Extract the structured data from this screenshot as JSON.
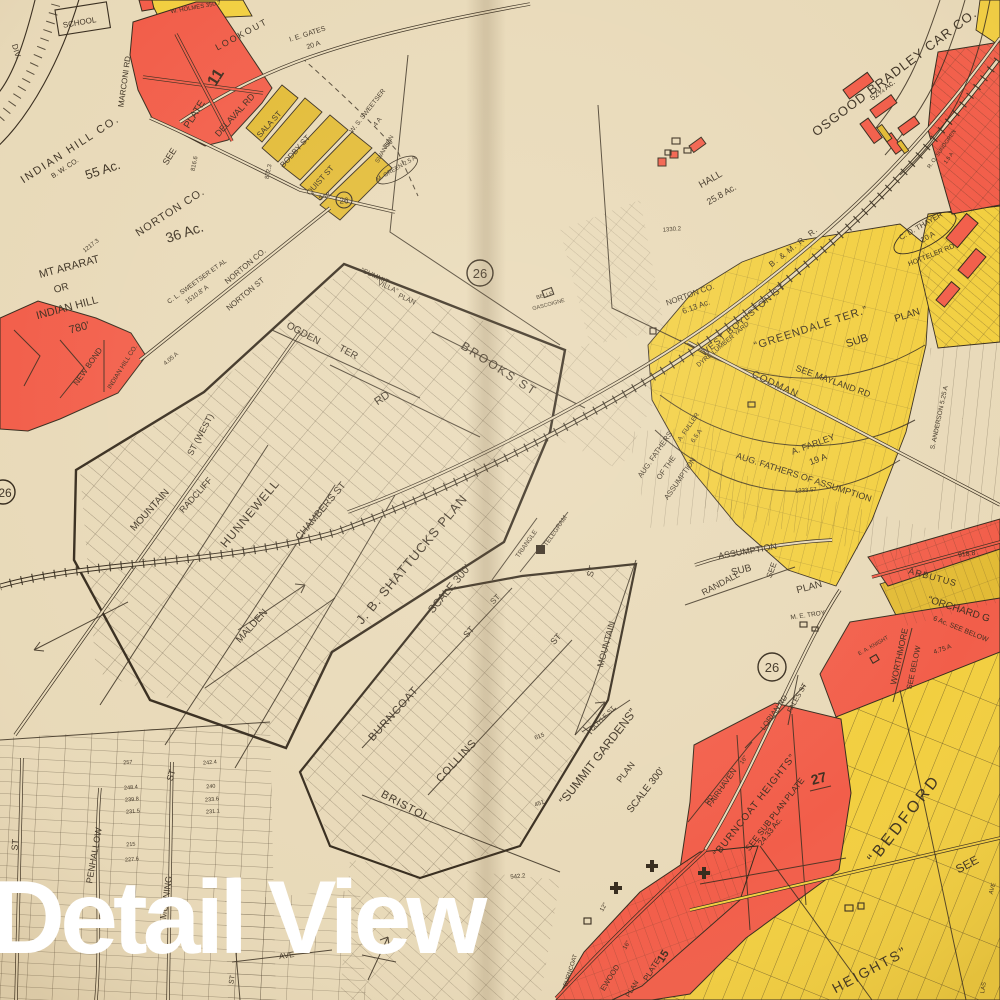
{
  "overlay": {
    "title": "Detail View"
  },
  "palette": {
    "paper": "#e8d9b8",
    "ink": "#33281a",
    "red": "#f25b47",
    "yellow": "#f2ce3d",
    "yellow_deep": "#e2ba32",
    "white": "#ffffff"
  },
  "plate": {
    "number": "26"
  },
  "map_labels": [
    {
      "n": "div",
      "t": "DIV.",
      "x": 14,
      "y": 52,
      "r": 73,
      "s": 8
    },
    {
      "n": "school",
      "t": "SCHOOL",
      "x": 80,
      "y": 25,
      "r": -10,
      "s": 8
    },
    {
      "n": "holmes",
      "t": "W. HOLMES 350.7",
      "x": 196,
      "y": 9,
      "r": -10,
      "s": 6
    },
    {
      "n": "lookout",
      "t": "LOOKOUT",
      "x": 243,
      "y": 37,
      "r": -28,
      "s": 9,
      "ls": 2
    },
    {
      "n": "gates-1",
      "t": "I. E. GATES",
      "x": 308,
      "y": 36,
      "r": -18,
      "s": 7
    },
    {
      "n": "gates-2",
      "t": "20 A",
      "x": 314,
      "y": 47,
      "r": -18,
      "s": 7
    },
    {
      "n": "see-plate-see",
      "t": "SEE",
      "x": 172,
      "y": 158,
      "r": -58,
      "s": 9
    },
    {
      "n": "see-plate-plate",
      "t": "PLATE",
      "x": 197,
      "y": 116,
      "r": -58,
      "s": 10
    },
    {
      "n": "see-plate-11",
      "t": "11",
      "x": 220,
      "y": 80,
      "r": -58,
      "s": 16,
      "b": 1
    },
    {
      "n": "marconi-rd",
      "t": "MARCONI RD",
      "x": 127,
      "y": 82,
      "r": -82,
      "s": 8
    },
    {
      "n": "delaval-rd",
      "t": "DELAVAL RD",
      "x": 237,
      "y": 117,
      "r": -48,
      "s": 9
    },
    {
      "n": "sala-st",
      "t": "SALA ST",
      "x": 271,
      "y": 126,
      "r": -48,
      "s": 8
    },
    {
      "n": "bodby-st",
      "t": "BODBY ST",
      "x": 297,
      "y": 153,
      "r": -48,
      "s": 8
    },
    {
      "n": "quist-st",
      "t": "QUIST ST",
      "x": 322,
      "y": 182,
      "r": -48,
      "s": 8
    },
    {
      "n": "ws-sweetser-1",
      "t": "W. S. SWEETSER",
      "x": 369,
      "y": 112,
      "r": -52,
      "s": 6.5
    },
    {
      "n": "ws-sweetser-2",
      "t": "4 A",
      "x": 379,
      "y": 123,
      "r": -52,
      "s": 6.5
    },
    {
      "n": "swanson",
      "t": "SWANSON",
      "x": 386,
      "y": 150,
      "r": -60,
      "s": 6
    },
    {
      "n": "m-green",
      "t": "M. GREEN 2.5 A",
      "x": 397,
      "y": 170,
      "r": -30,
      "s": 6
    },
    {
      "n": "n548",
      "t": "548.",
      "x": 326,
      "y": 198,
      "r": -20,
      "s": 7
    },
    {
      "n": "n350",
      "t": "350",
      "x": 389,
      "y": 146,
      "r": -40,
      "s": 6.5
    },
    {
      "n": "indian-hill-co",
      "t": "INDIAN HILL CO.",
      "x": 72,
      "y": 152,
      "r": -33,
      "s": 11,
      "ls": 2
    },
    {
      "n": "bw-co",
      "t": "B. W. CO.",
      "x": 66,
      "y": 170,
      "r": -33,
      "s": 7
    },
    {
      "n": "ac-55",
      "t": "55 Ac.",
      "x": 104,
      "y": 174,
      "r": -18,
      "s": 13
    },
    {
      "n": "n816",
      "t": "816.6",
      "x": 196,
      "y": 164,
      "r": -78,
      "s": 6
    },
    {
      "n": "n872",
      "t": "872.3",
      "x": 270,
      "y": 172,
      "r": -78,
      "s": 6
    },
    {
      "n": "norton-co-1",
      "t": "NORTON CO.",
      "x": 172,
      "y": 215,
      "r": -33,
      "s": 11,
      "ls": 1
    },
    {
      "n": "ac-36",
      "t": "36 Ac.",
      "x": 186,
      "y": 237,
      "r": -18,
      "s": 14
    },
    {
      "n": "n1217",
      "t": "1217.3",
      "x": 92,
      "y": 247,
      "r": -38,
      "s": 6
    },
    {
      "n": "mt-ararat-1",
      "t": "MT ARARAT",
      "x": 70,
      "y": 270,
      "r": -15,
      "s": 11
    },
    {
      "n": "mt-ararat-2",
      "t": "OR",
      "x": 62,
      "y": 291,
      "r": -15,
      "s": 10
    },
    {
      "n": "mt-ararat-3",
      "t": "INDIAN HILL",
      "x": 68,
      "y": 311,
      "r": -15,
      "s": 11
    },
    {
      "n": "mt-ararat-4",
      "t": "780'",
      "x": 80,
      "y": 331,
      "r": -15,
      "s": 11
    },
    {
      "n": "cl-sweetser-1",
      "t": "C. L. SWEETSER ET AL",
      "x": 198,
      "y": 283,
      "r": -36,
      "s": 6.5
    },
    {
      "n": "cl-sweetser-2",
      "t": "1510.8' A",
      "x": 198,
      "y": 296,
      "r": -36,
      "s": 6.5
    },
    {
      "n": "norton-co-2",
      "t": "NORTON CO.",
      "x": 247,
      "y": 268,
      "r": -40,
      "s": 8
    },
    {
      "n": "norton-st",
      "t": "NORTON ST",
      "x": 247,
      "y": 296,
      "r": -40,
      "s": 8
    },
    {
      "n": "new-bond",
      "t": "NEW BOND",
      "x": 90,
      "y": 368,
      "r": -55,
      "s": 8
    },
    {
      "n": "indian-hill-co-2",
      "t": "INDIAN HILL CO.",
      "x": 124,
      "y": 368,
      "r": -58,
      "s": 6.5
    },
    {
      "n": "n405",
      "t": "4.05 A",
      "x": 172,
      "y": 360,
      "r": -40,
      "s": 6
    },
    {
      "n": "st-west",
      "t": "ST (WEST)",
      "x": 203,
      "y": 436,
      "r": -62,
      "s": 9
    },
    {
      "n": "mountain-st-w",
      "t": "MOUNTAIN",
      "x": 152,
      "y": 512,
      "r": -48,
      "s": 10
    },
    {
      "n": "radcliff",
      "t": "RADCLIFF",
      "x": 198,
      "y": 497,
      "r": -48,
      "s": 9
    },
    {
      "n": "hunnewell",
      "t": "HUNNEWELL",
      "x": 253,
      "y": 516,
      "r": -50,
      "s": 12,
      "ls": 1
    },
    {
      "n": "chambers-st",
      "t": "CHAMBERS ST",
      "x": 323,
      "y": 513,
      "r": -50,
      "s": 10
    },
    {
      "n": "malden",
      "t": "MALDEN",
      "x": 254,
      "y": 628,
      "r": -48,
      "s": 10
    },
    {
      "n": "ogden",
      "t": "OGDEN",
      "x": 302,
      "y": 336,
      "r": 28,
      "s": 10
    },
    {
      "n": "ogden-ter",
      "t": "TER",
      "x": 347,
      "y": 355,
      "r": 28,
      "s": 10
    },
    {
      "n": "rd",
      "t": "RD",
      "x": 384,
      "y": 401,
      "r": -35,
      "s": 11
    },
    {
      "n": "brooks-st",
      "t": "BROOKS ST",
      "x": 497,
      "y": 372,
      "r": 33,
      "s": 12,
      "ls": 2
    },
    {
      "n": "summit-villa-1",
      "t": "“SUMMIT",
      "x": 374,
      "y": 278,
      "r": 25,
      "s": 7
    },
    {
      "n": "summit-villa-2",
      "t": "VILLA”",
      "x": 387,
      "y": 289,
      "r": 25,
      "s": 7
    },
    {
      "n": "summit-villa-3",
      "t": "PLAN",
      "x": 406,
      "y": 301,
      "r": 25,
      "s": 7
    },
    {
      "n": "belle-gascoigne-1",
      "t": "BELLE",
      "x": 545,
      "y": 297,
      "r": -15,
      "s": 5.5
    },
    {
      "n": "belle-gascoigne-2",
      "t": "GASCOIGNE",
      "x": 549,
      "y": 306,
      "r": -15,
      "s": 5.5
    },
    {
      "n": "shattucks-plan",
      "t": "J. B. SHATTUCKS PLAN",
      "x": 415,
      "y": 562,
      "r": -50,
      "s": 13,
      "ls": 1
    },
    {
      "n": "shattucks-scale",
      "t": "SCALE 300'",
      "x": 452,
      "y": 591,
      "r": -50,
      "s": 11
    },
    {
      "n": "triangle",
      "t": "TRIANGLE",
      "x": 528,
      "y": 545,
      "r": -55,
      "s": 6.5
    },
    {
      "n": "telegram",
      "t": "TELEGRAM",
      "x": 557,
      "y": 532,
      "r": -55,
      "s": 6.5
    },
    {
      "n": "st-1",
      "t": "ST",
      "x": 497,
      "y": 601,
      "r": -45,
      "s": 8
    },
    {
      "n": "burncoat-sg",
      "t": "BURNCOAT",
      "x": 396,
      "y": 716,
      "r": -48,
      "s": 11,
      "ls": 1
    },
    {
      "n": "burncoat-sg-st",
      "t": "ST",
      "x": 471,
      "y": 634,
      "r": -48,
      "s": 9
    },
    {
      "n": "collins",
      "t": "COLLINS",
      "x": 459,
      "y": 763,
      "r": -47,
      "s": 11,
      "ls": 1
    },
    {
      "n": "collins-st",
      "t": "ST",
      "x": 558,
      "y": 641,
      "r": -47,
      "s": 9
    },
    {
      "n": "bristol",
      "t": "BRISTOL",
      "x": 404,
      "y": 809,
      "r": 28,
      "s": 11,
      "ls": 1
    },
    {
      "n": "mountain-st-e",
      "t": "MOUNTAIN",
      "x": 609,
      "y": 645,
      "r": -75,
      "s": 9
    },
    {
      "n": "mountain-st-e-st",
      "t": "ST",
      "x": 594,
      "y": 572,
      "r": -75,
      "s": 9
    },
    {
      "n": "doyle-st",
      "t": "DOYLE ST",
      "x": 604,
      "y": 720,
      "r": -45,
      "s": 6.5
    },
    {
      "n": "summit-gardens",
      "t": "“SUMMIT GARDENS”",
      "x": 601,
      "y": 759,
      "r": -52,
      "s": 12
    },
    {
      "n": "summit-gardens-plan",
      "t": "PLAN",
      "x": 628,
      "y": 774,
      "r": -52,
      "s": 9
    },
    {
      "n": "summit-gardens-scale",
      "t": "SCALE 300'",
      "x": 648,
      "y": 792,
      "r": -52,
      "s": 10
    },
    {
      "n": "n615",
      "t": "615",
      "x": 540,
      "y": 738,
      "r": -20,
      "s": 6
    },
    {
      "n": "n451",
      "t": "451",
      "x": 540,
      "y": 805,
      "r": -20,
      "s": 6
    },
    {
      "n": "n5422",
      "t": "542.2",
      "x": 518,
      "y": 878,
      "r": -5,
      "s": 6
    },
    {
      "n": "penhallow",
      "t": "PENHALLOW",
      "x": 97,
      "y": 856,
      "r": -80,
      "s": 9
    },
    {
      "n": "morning-st-st",
      "t": "ST",
      "x": 174,
      "y": 776,
      "r": -75,
      "s": 9
    },
    {
      "n": "morning-st",
      "t": "MORNING",
      "x": 169,
      "y": 898,
      "r": -82,
      "s": 9
    },
    {
      "n": "st-bottom-left",
      "t": "ST",
      "x": 18,
      "y": 845,
      "r": -85,
      "s": 9
    },
    {
      "n": "lot-num-a",
      "t": "257",
      "x": 128,
      "y": 764,
      "r": -5,
      "s": 5.5
    },
    {
      "n": "lot-num-b",
      "t": "248.4",
      "x": 131,
      "y": 789,
      "r": -5,
      "s": 5.5
    },
    {
      "n": "lot-num-c",
      "t": "239.8",
      "x": 132,
      "y": 801,
      "r": -5,
      "s": 5.5
    },
    {
      "n": "lot-num-d",
      "t": "231.5",
      "x": 133,
      "y": 813,
      "r": -5,
      "s": 5.5
    },
    {
      "n": "lot-num-e",
      "t": "215",
      "x": 131,
      "y": 846,
      "r": -5,
      "s": 5.5
    },
    {
      "n": "lot-num-f",
      "t": "227.6",
      "x": 132,
      "y": 861,
      "r": -5,
      "s": 5.5
    },
    {
      "n": "lot-num-g",
      "t": "242.4",
      "x": 210,
      "y": 764,
      "r": -5,
      "s": 5.5
    },
    {
      "n": "lot-num-h",
      "t": "240",
      "x": 211,
      "y": 788,
      "r": -5,
      "s": 5.5
    },
    {
      "n": "lot-num-i",
      "t": "233.6",
      "x": 212,
      "y": 801,
      "r": -5,
      "s": 5.5
    },
    {
      "n": "lot-num-j",
      "t": "231.1",
      "x": 213,
      "y": 813,
      "r": -5,
      "s": 5.5
    },
    {
      "n": "ave",
      "t": "AVE",
      "x": 287,
      "y": 958,
      "r": -8,
      "s": 8
    },
    {
      "n": "st-mid",
      "t": "ST",
      "x": 234,
      "y": 980,
      "r": -80,
      "s": 7
    },
    {
      "n": "hall-1",
      "t": "HALL",
      "x": 712,
      "y": 182,
      "r": -30,
      "s": 10
    },
    {
      "n": "hall-2",
      "t": "25.8 Ac.",
      "x": 723,
      "y": 197,
      "r": -30,
      "s": 9
    },
    {
      "n": "osgood",
      "t": "OSGOOD BRADLEY CAR CO.",
      "x": 897,
      "y": 76,
      "r": -37,
      "s": 13,
      "ls": 1
    },
    {
      "n": "osgood-ac",
      "t": "52¾ Ac.",
      "x": 884,
      "y": 92,
      "r": -37,
      "s": 8
    },
    {
      "n": "n1330",
      "t": "1330.2",
      "x": 672,
      "y": 231,
      "r": -5,
      "s": 6
    },
    {
      "n": "bm-rr",
      "t": "B. & M. R. R.",
      "x": 795,
      "y": 249,
      "r": -38,
      "s": 8,
      "ls": 1
    },
    {
      "n": "west-boylston-st",
      "t": "WEST BOYLSTON ST",
      "x": 745,
      "y": 322,
      "r": -40,
      "s": 9,
      "ls": 1
    },
    {
      "n": "dyre-lumber",
      "t": "DYRE LUMBER YARD",
      "x": 724,
      "y": 346,
      "r": -40,
      "s": 6.5
    },
    {
      "n": "norton-613-1",
      "t": "NORTON CO.",
      "x": 691,
      "y": 297,
      "r": -20,
      "s": 8
    },
    {
      "n": "norton-613-2",
      "t": "6.13 Ac.",
      "x": 697,
      "y": 309,
      "r": -20,
      "s": 8
    },
    {
      "n": "thayer-1",
      "t": "C. D. THAYER",
      "x": 922,
      "y": 228,
      "r": -30,
      "s": 7.5
    },
    {
      "n": "thayer-2",
      "t": "20 A",
      "x": 929,
      "y": 239,
      "r": -30,
      "s": 7.5
    },
    {
      "n": "hotteler-rd",
      "t": "HOTTELER RD",
      "x": 932,
      "y": 257,
      "r": -22,
      "s": 7
    },
    {
      "n": "sundgren-1",
      "t": "R. O. SUNDGREN",
      "x": 943,
      "y": 150,
      "r": -55,
      "s": 5.5
    },
    {
      "n": "sundgren-2",
      "t": "1.5 A",
      "x": 950,
      "y": 159,
      "r": -55,
      "s": 5.5
    },
    {
      "n": "greendale-ter",
      "t": "“GREENDALE TER.”",
      "x": 812,
      "y": 331,
      "r": -18,
      "s": 11,
      "ls": 1
    },
    {
      "n": "greendale-sub",
      "t": "SUB",
      "x": 858,
      "y": 344,
      "r": -18,
      "s": 11
    },
    {
      "n": "greendale-plan",
      "t": "PLAN",
      "x": 908,
      "y": 318,
      "r": -18,
      "s": 10
    },
    {
      "n": "see-mayland-rd",
      "t": "SEE MAYLAND RD",
      "x": 832,
      "y": 384,
      "r": 20,
      "s": 9
    },
    {
      "n": "codman",
      "t": "CODMAN",
      "x": 774,
      "y": 387,
      "r": 25,
      "s": 10,
      "ls": 1
    },
    {
      "n": "fuller-1",
      "t": "A. FULLER",
      "x": 690,
      "y": 428,
      "r": -55,
      "s": 6.5
    },
    {
      "n": "fuller-2",
      "t": "6.5 A",
      "x": 698,
      "y": 437,
      "r": -55,
      "s": 6.5
    },
    {
      "n": "aug-fathers-1a",
      "t": "AUG. FATHERS",
      "x": 657,
      "y": 456,
      "r": -55,
      "s": 7.5
    },
    {
      "n": "aug-fathers-1b",
      "t": "OF THE",
      "x": 668,
      "y": 469,
      "r": -55,
      "s": 7.5
    },
    {
      "n": "aug-fathers-1c",
      "t": "ASSUMPTION",
      "x": 682,
      "y": 480,
      "r": -55,
      "s": 7.5
    },
    {
      "n": "farley-1",
      "t": "A. FARLEY",
      "x": 814,
      "y": 447,
      "r": -20,
      "s": 9
    },
    {
      "n": "farley-2",
      "t": "19 A",
      "x": 819,
      "y": 462,
      "r": -20,
      "s": 9
    },
    {
      "n": "aug-fathers-2",
      "t": "AUG. FATHERS OF ASSUMPTION",
      "x": 803,
      "y": 480,
      "r": 18,
      "s": 9
    },
    {
      "n": "anderson",
      "t": "S. ANDERSON 5.25 A",
      "x": 941,
      "y": 418,
      "r": -78,
      "s": 6.5
    },
    {
      "n": "n1333",
      "t": "1333.57",
      "x": 806,
      "y": 492,
      "r": -5,
      "s": 6
    },
    {
      "n": "assumption-st",
      "t": "ASSUMPTION",
      "x": 748,
      "y": 554,
      "r": -10,
      "s": 9
    },
    {
      "n": "sub-see-1",
      "t": "SUB",
      "x": 742,
      "y": 573,
      "r": -15,
      "s": 10
    },
    {
      "n": "sub-see-2",
      "t": "SEE",
      "x": 774,
      "y": 571,
      "r": -70,
      "s": 8
    },
    {
      "n": "sub-see-3",
      "t": "PLAN",
      "x": 810,
      "y": 590,
      "r": -15,
      "s": 10
    },
    {
      "n": "randall",
      "t": "RANDALL",
      "x": 722,
      "y": 586,
      "r": -28,
      "s": 9
    },
    {
      "n": "me-troy",
      "t": "M. E. TROY",
      "x": 808,
      "y": 617,
      "r": -8,
      "s": 6.5
    },
    {
      "n": "fales-st",
      "t": "FALES ST",
      "x": 799,
      "y": 699,
      "r": -60,
      "s": 7
    },
    {
      "n": "n9188",
      "t": "918.8",
      "x": 967,
      "y": 556,
      "r": -8,
      "s": 7
    },
    {
      "n": "arbutus",
      "t": "ARBUTUS",
      "x": 932,
      "y": 580,
      "r": 15,
      "s": 9,
      "ls": 1
    },
    {
      "n": "orchard-1",
      "t": "“ORCHARD G",
      "x": 958,
      "y": 612,
      "r": 18,
      "s": 10
    },
    {
      "n": "orchard-2",
      "t": "6 Ac. SEE BELOW",
      "x": 960,
      "y": 631,
      "r": 22,
      "s": 7
    },
    {
      "n": "worthmore",
      "t": "WORTHMORE",
      "x": 902,
      "y": 657,
      "r": -78,
      "s": 8.5
    },
    {
      "n": "see-below",
      "t": "SEE BELOW",
      "x": 916,
      "y": 668,
      "r": -78,
      "s": 7.5
    },
    {
      "n": "ea-knight",
      "t": "E. A. KNIGHT",
      "x": 874,
      "y": 647,
      "r": -30,
      "s": 5.5
    },
    {
      "n": "n475",
      "t": "4.75 A",
      "x": 943,
      "y": 651,
      "r": -20,
      "s": 6.5
    },
    {
      "n": "lorian-rd",
      "t": "LORIAN RD",
      "x": 776,
      "y": 714,
      "r": -55,
      "s": 7.5
    },
    {
      "n": "fairhaven",
      "t": "FAIRHAVEN",
      "x": 724,
      "y": 789,
      "r": -55,
      "s": 8
    },
    {
      "n": "fairhaven-rd",
      "t": "RD",
      "x": 711,
      "y": 801,
      "r": -55,
      "s": 7
    },
    {
      "n": "burncoat-heights",
      "t": "“BURNCOAT HEIGHTS”",
      "x": 757,
      "y": 807,
      "r": -52,
      "s": 10,
      "ls": 1
    },
    {
      "n": "see-sub-plan-plate",
      "t": "SEE SUB PLAN PLATE",
      "x": 777,
      "y": 816,
      "r": -52,
      "s": 8.5
    },
    {
      "n": "n2433",
      "t": "24.33 Ac.",
      "x": 772,
      "y": 833,
      "r": -52,
      "s": 8
    },
    {
      "n": "n27",
      "t": "27",
      "x": 820,
      "y": 783,
      "r": -15,
      "s": 14,
      "b": 1
    },
    {
      "n": "n16a",
      "t": "16\"",
      "x": 745,
      "y": 761,
      "r": -55,
      "s": 6
    },
    {
      "n": "n16b",
      "t": "16\"",
      "x": 628,
      "y": 946,
      "r": -60,
      "s": 6
    },
    {
      "n": "n12",
      "t": "12\"",
      "x": 605,
      "y": 908,
      "r": -60,
      "s": 6
    },
    {
      "n": "bedford",
      "t": "“BEDFORD",
      "x": 908,
      "y": 822,
      "r": -52,
      "s": 16,
      "ls": 3
    },
    {
      "n": "heights",
      "t": "HEIGHTS”",
      "x": 872,
      "y": 974,
      "r": -28,
      "s": 14,
      "ls": 2
    },
    {
      "n": "see-bedford",
      "t": "SEE",
      "x": 969,
      "y": 868,
      "r": -28,
      "s": 12
    },
    {
      "n": "ave-2",
      "t": "AVE",
      "x": 994,
      "y": 889,
      "r": -75,
      "s": 6
    },
    {
      "n": "las",
      "t": "LAS",
      "x": 985,
      "y": 988,
      "r": -80,
      "s": 6
    },
    {
      "n": "burncoat-v",
      "t": "BURNCOAT",
      "x": 572,
      "y": 971,
      "r": -72,
      "s": 6
    },
    {
      "n": "ewood",
      "t": "EWOOD",
      "x": 612,
      "y": 979,
      "r": -58,
      "s": 7.5
    },
    {
      "n": "ewood-plan",
      "t": "PLAN",
      "x": 634,
      "y": 990,
      "r": -58,
      "s": 7
    },
    {
      "n": "plate-15-a",
      "t": "PLATE",
      "x": 654,
      "y": 971,
      "r": -58,
      "s": 8
    },
    {
      "n": "plate-15-b",
      "t": "15",
      "x": 666,
      "y": 958,
      "r": -58,
      "s": 11,
      "b": 1
    }
  ]
}
